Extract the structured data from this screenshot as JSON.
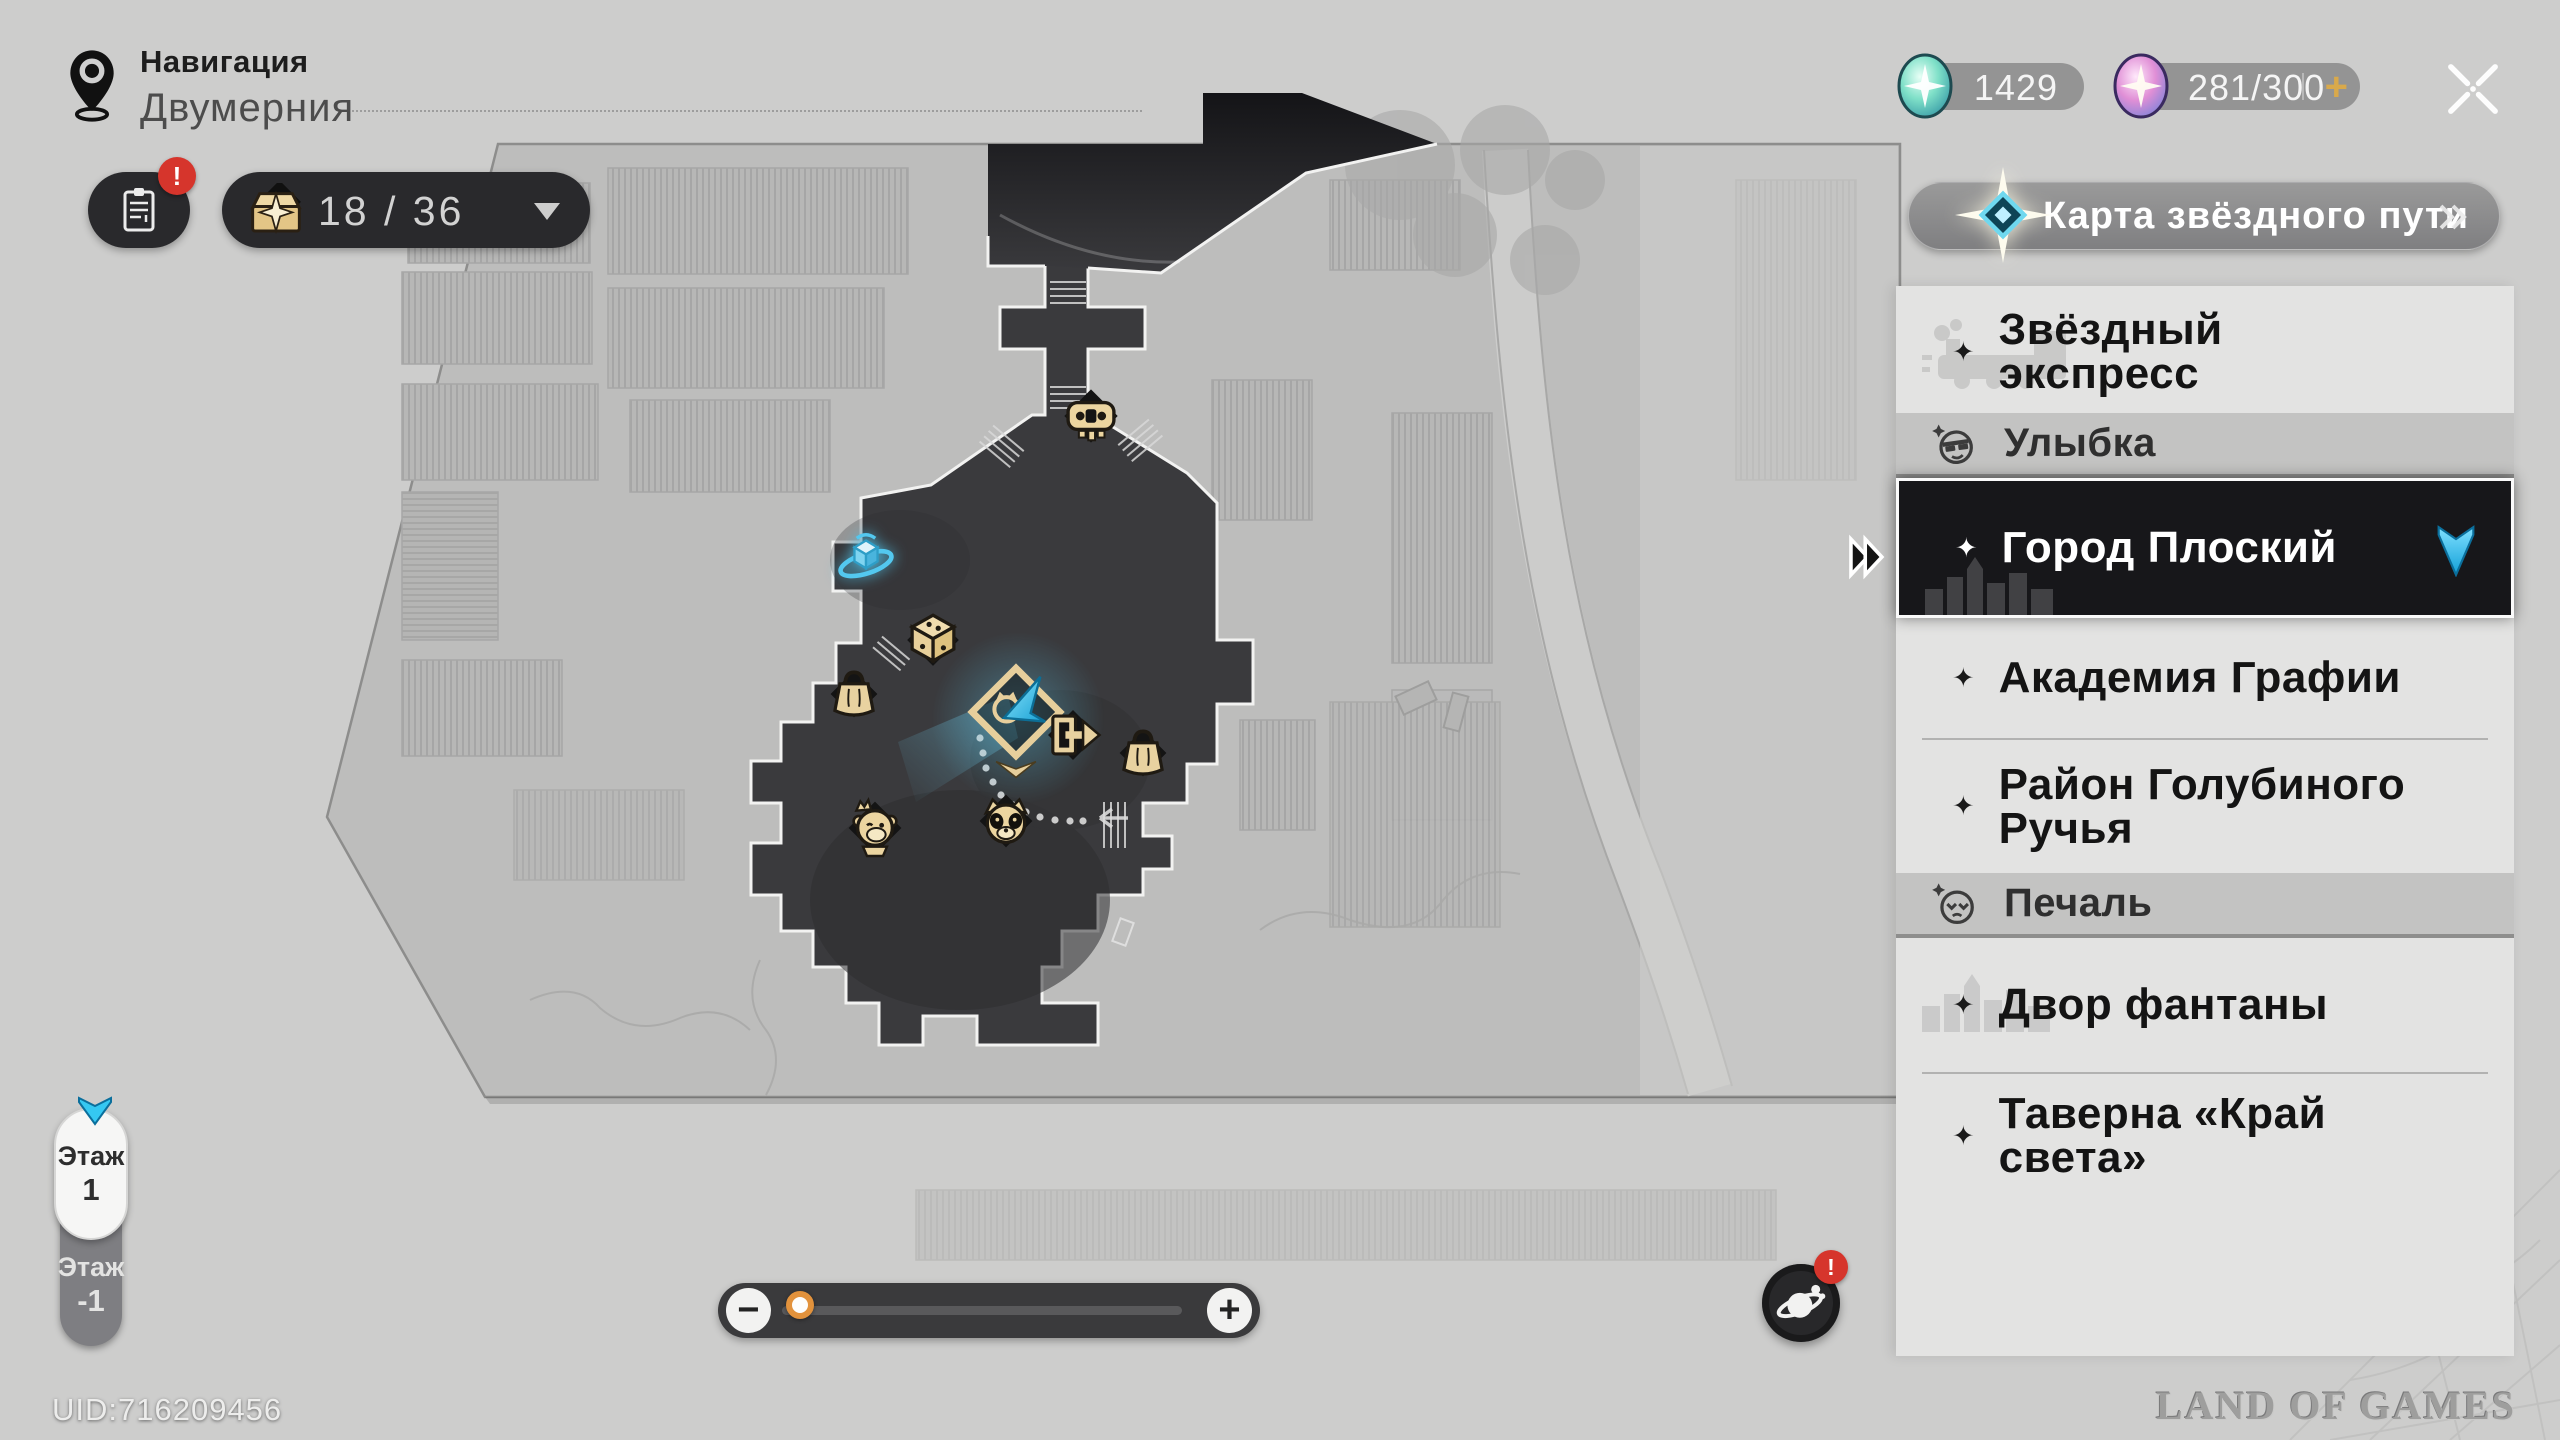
{
  "header": {
    "nav_label": "Навигация",
    "location": "Двумерния"
  },
  "toolbar": {
    "chest_count": "18 / 36"
  },
  "currency": {
    "jade": "1429",
    "power": "281/300",
    "add": "+"
  },
  "alert_badge": "!",
  "side": {
    "header": "Карта звёздного пути",
    "items": [
      {
        "type": "location",
        "label": "Звёздный экспресс"
      },
      {
        "type": "section",
        "label": "Улыбка"
      },
      {
        "type": "location",
        "label": "Город Плоский",
        "selected": true
      },
      {
        "type": "location",
        "label": "Академия Графии"
      },
      {
        "type": "location",
        "label": "Район Голубиного Ручья"
      },
      {
        "type": "section",
        "label": "Печаль"
      },
      {
        "type": "location",
        "label": "Двор фантаны"
      },
      {
        "type": "location",
        "label": "Таверна «Край света»"
      }
    ]
  },
  "floors": {
    "upper_label": "Этаж",
    "upper_value": "1",
    "lower_label": "Этаж",
    "lower_value": "-1"
  },
  "zoom": {
    "minus": "−",
    "plus": "+",
    "level_pct": 8
  },
  "footer": {
    "uid": "UID:716209456",
    "watermark": "LAND OF GAMES"
  },
  "map": {
    "floor_shown": "1",
    "icons": [
      "robot-vendor",
      "space-anchor",
      "treasure-box",
      "shop-bag",
      "teleport-waypoint",
      "player-marker",
      "exit-door",
      "shop-bag",
      "monkey-npc",
      "raccoon-npc"
    ],
    "colors": {
      "explored": "#3a3a3d",
      "paper": "#cdcdcc",
      "plan": "#bdbdbc",
      "accent_cyan": "#35c8f2",
      "icon_tan": "#e8d2a0"
    }
  }
}
